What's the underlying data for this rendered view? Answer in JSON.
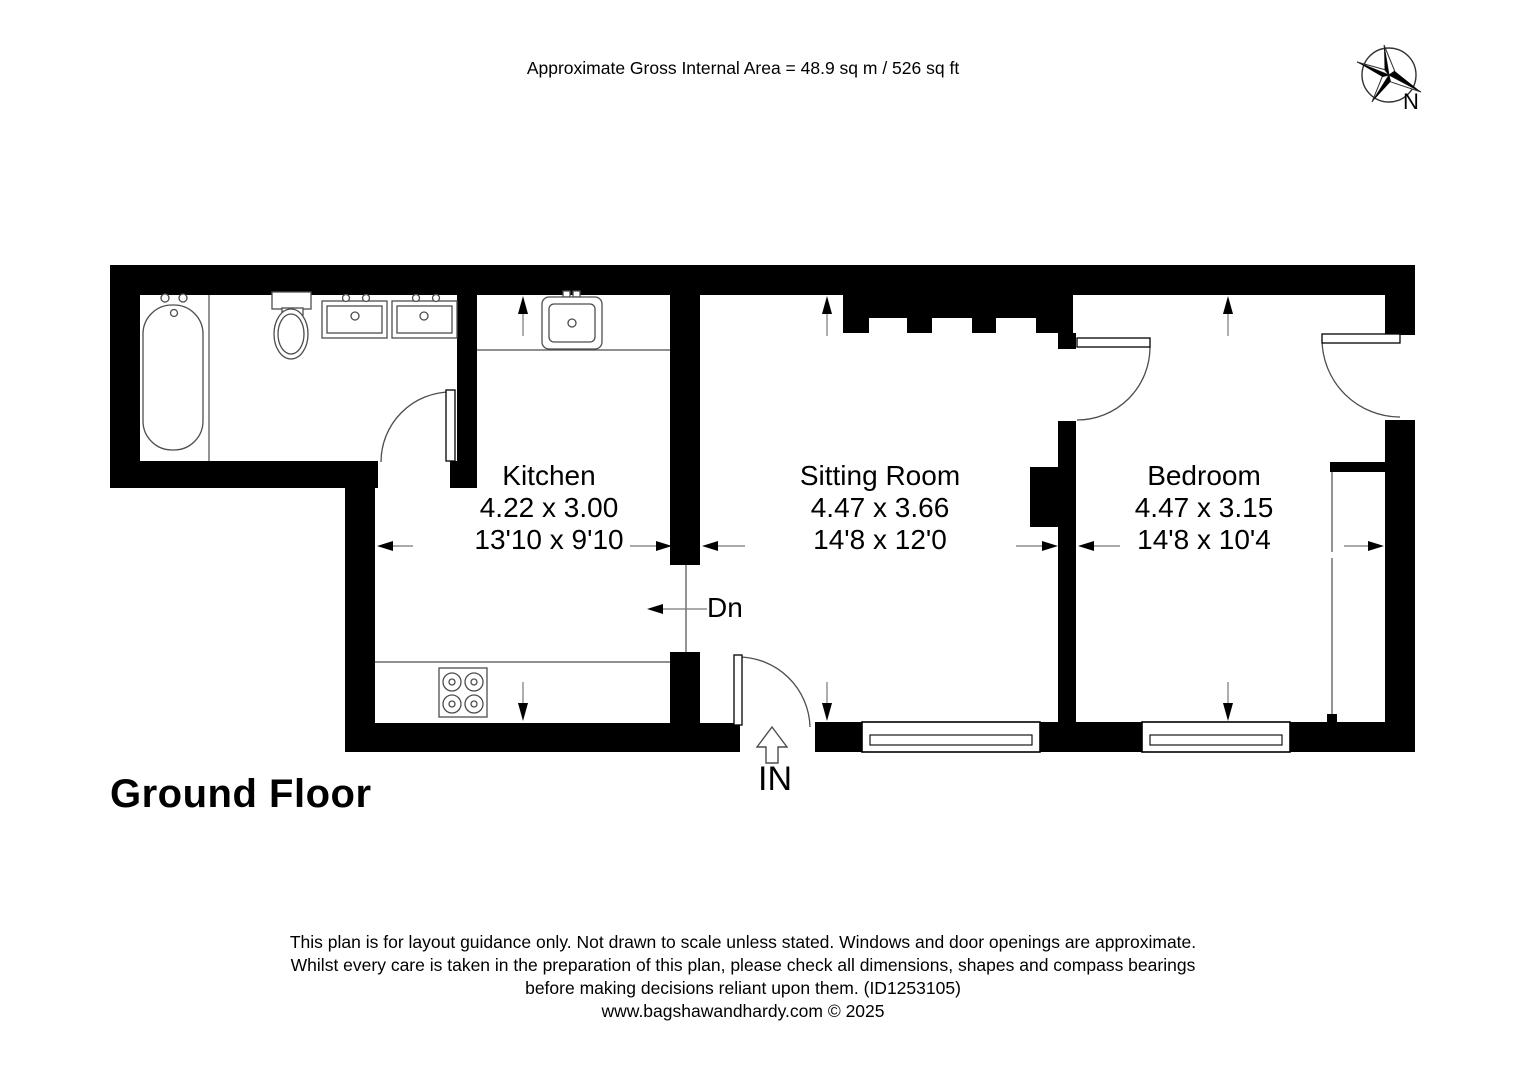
{
  "header": {
    "area_text": "Approximate Gross Internal Area = 48.9 sq m / 526 sq ft"
  },
  "compass": {
    "label": "N"
  },
  "floor": {
    "label": "Ground Floor"
  },
  "rooms": [
    {
      "id": "kitchen",
      "name": "Kitchen",
      "metric": "4.22 x 3.00",
      "imperial": "13'10 x 9'10"
    },
    {
      "id": "sitting-room",
      "name": "Sitting Room",
      "metric": "4.47 x 3.66",
      "imperial": "14'8 x 12'0"
    },
    {
      "id": "bedroom",
      "name": "Bedroom",
      "metric": "4.47 x 3.15",
      "imperial": "14'8 x 10'4"
    }
  ],
  "annotations": {
    "stairs_down": "Dn",
    "entrance": "IN"
  },
  "footer": {
    "line1": "This plan is for layout guidance only. Not drawn to scale unless stated. Windows and door openings are approximate.",
    "line2": "Whilst every care is taken in the preparation of this plan, please check all dimensions, shapes and compass bearings",
    "line3": "before making decisions reliant upon them. (ID1253105)",
    "website": "www.bagshawandhardy.com © 2025"
  },
  "colors": {
    "wall": "#000000",
    "fixture_line": "#4d4d4d",
    "dimension_line": "#777777"
  }
}
